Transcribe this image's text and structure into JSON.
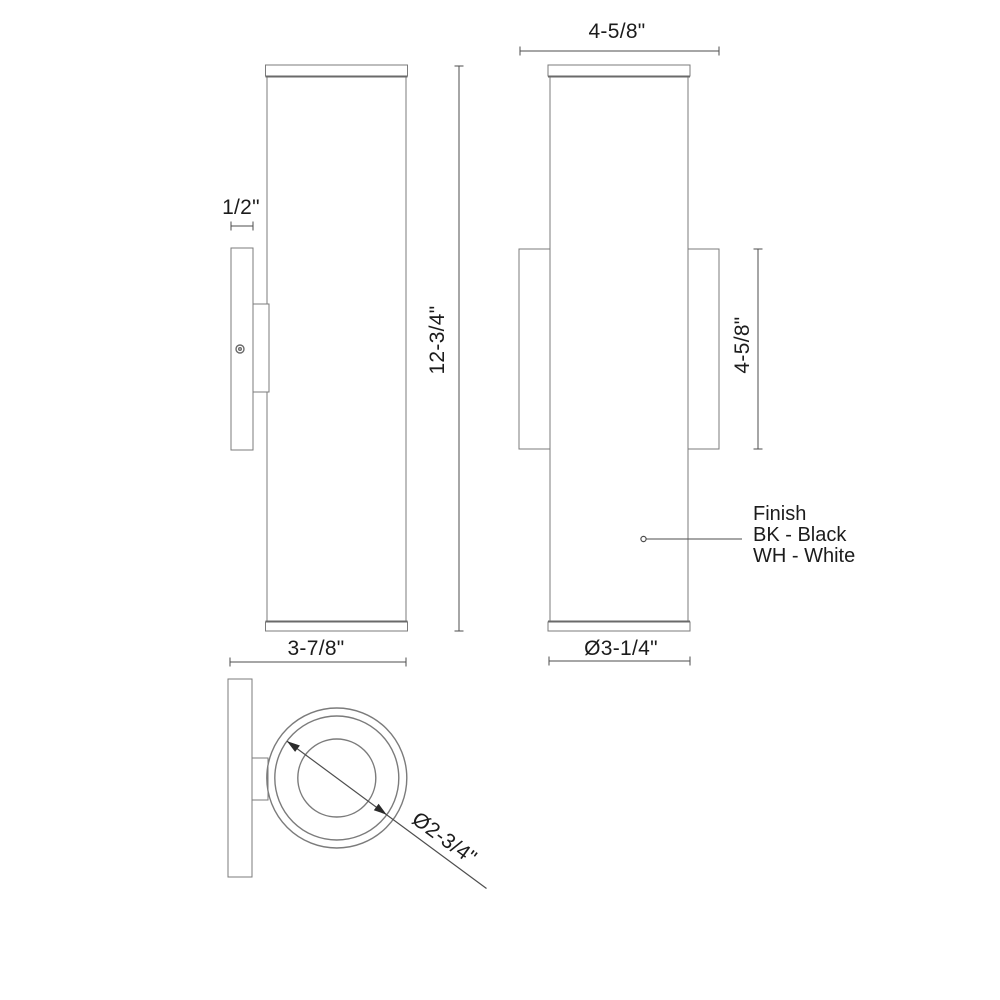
{
  "drawing": {
    "type": "technical-dimension-drawing",
    "subject": "cylindrical wall sconce, three orthographic views",
    "colors": {
      "background": "#ffffff",
      "outline": "#7b7b7b",
      "cap_line": "#6a6a6a",
      "dimension_line": "#4e4e4e",
      "arrow_fill": "#2b2b2b",
      "text": "#1c1c1c"
    }
  },
  "dimensions": {
    "plate_depth": "1/2\"",
    "fixture_width_top": "4-5/8\"",
    "body_height": "12-3/4\"",
    "backplate_height": "4-5/8\"",
    "overall_depth": "3-7/8\"",
    "body_diameter": "Ø3-1/4\"",
    "inner_diameter": "Ø2-3/4\""
  },
  "finish_note": {
    "title": "Finish",
    "option_black": "BK - Black",
    "option_white": "WH - White"
  }
}
